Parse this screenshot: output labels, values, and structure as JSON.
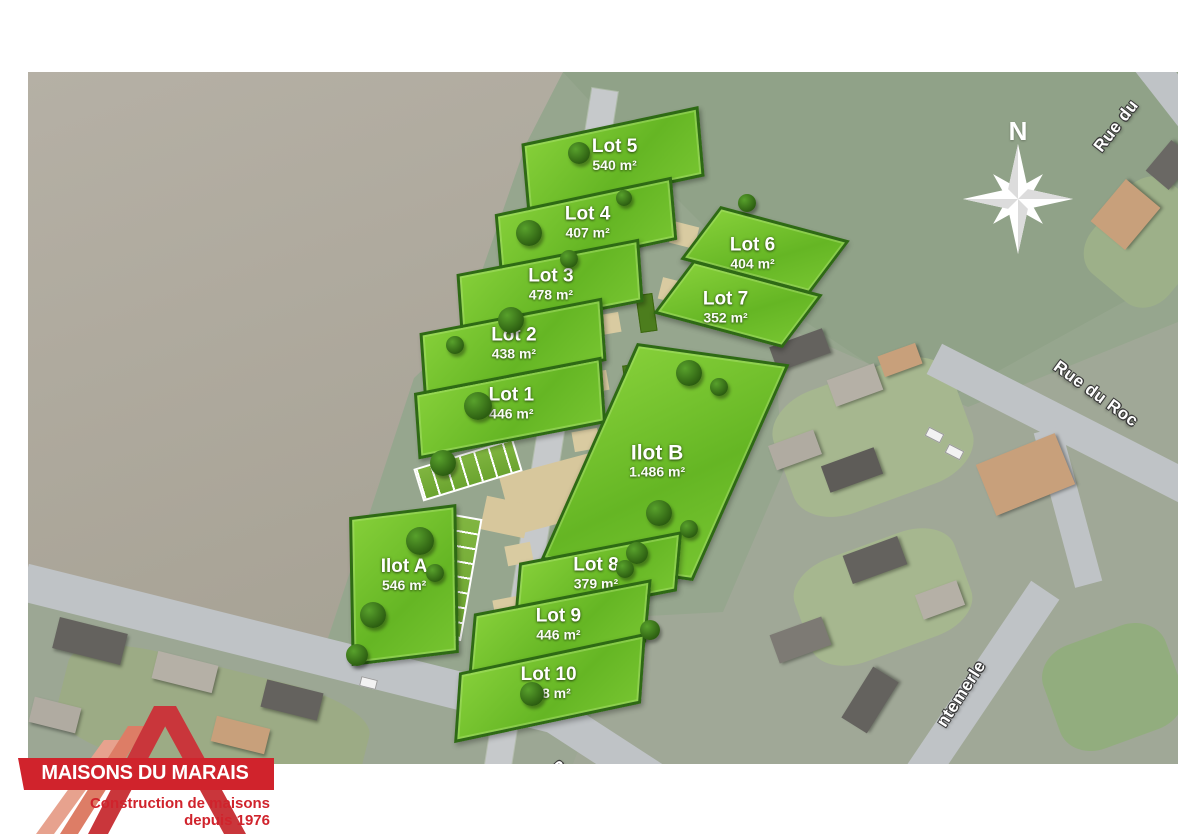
{
  "plan": {
    "compass_label": "N",
    "lots": [
      {
        "id": "lot-5",
        "name": "Lot 5",
        "area": "540 m²"
      },
      {
        "id": "lot-4",
        "name": "Lot 4",
        "area": "407 m²"
      },
      {
        "id": "lot-3",
        "name": "Lot 3",
        "area": "478 m²"
      },
      {
        "id": "lot-2",
        "name": "Lot 2",
        "area": "438 m²"
      },
      {
        "id": "lot-1",
        "name": "Lot 1",
        "area": "446 m²"
      },
      {
        "id": "lot-6",
        "name": "Lot 6",
        "area": "404 m²"
      },
      {
        "id": "lot-7",
        "name": "Lot 7",
        "area": "352 m²"
      },
      {
        "id": "ilot-b",
        "name": "Ilot B",
        "area": "1.486 m²"
      },
      {
        "id": "ilot-a",
        "name": "Ilot A",
        "area": "546 m²"
      },
      {
        "id": "lot-8",
        "name": "Lot 8",
        "area": "379 m²"
      },
      {
        "id": "lot-9",
        "name": "Lot 9",
        "area": "446 m²"
      },
      {
        "id": "lot-10",
        "name": "Lot 10",
        "area": "468 m²"
      }
    ],
    "streets": [
      {
        "id": "rue-du-top",
        "label": "Rue du"
      },
      {
        "id": "rue-du-roc",
        "label": "Rue du Roc"
      },
      {
        "id": "chantemerle",
        "label": "ntemerle"
      },
      {
        "id": "partial",
        "label": "R"
      }
    ]
  },
  "logo": {
    "title": "MAISONS DU MARAIS",
    "subtitle_line1": "Construction de maisons",
    "subtitle_line2": "depuis 1976"
  },
  "colors": {
    "brand_red": "#d0232c",
    "lot_green": "#6fbe2b",
    "lot_border_green": "#2e6a14",
    "field_brown": "#aba69b",
    "field_sage": "#96a68e",
    "road_gray": "#bfc3c6",
    "plaza_beige": "#d7c79c",
    "label_white": "#ffffff"
  }
}
